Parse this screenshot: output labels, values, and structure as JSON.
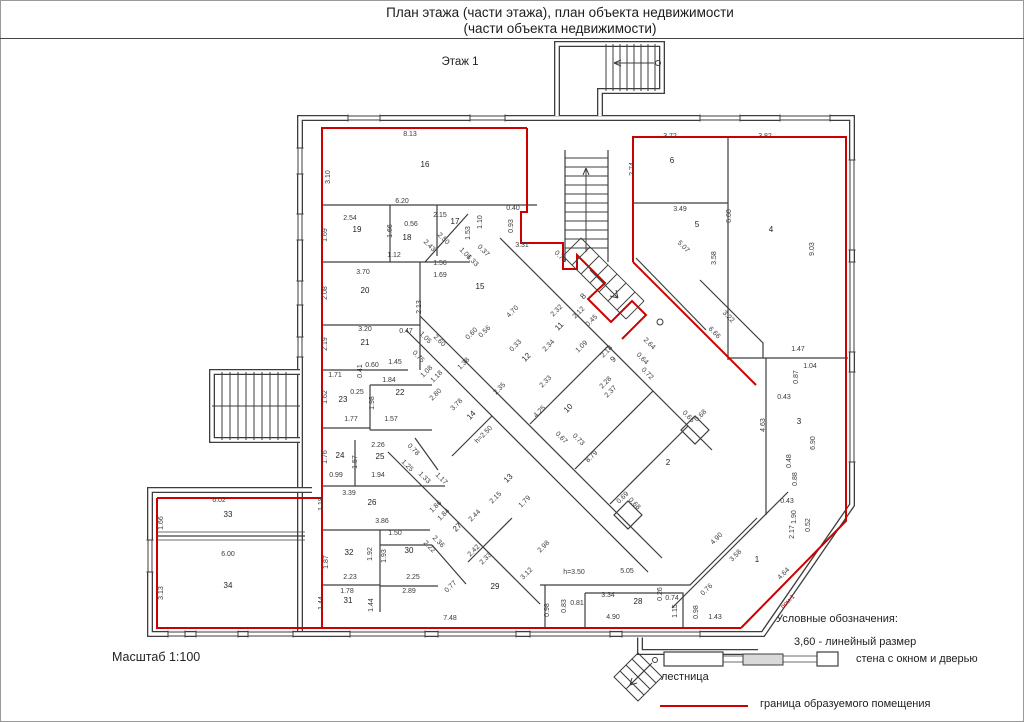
{
  "title": {
    "line1": "План этажа (части этажа), план объекта недвижимости",
    "line2": "(части объекта недвижимости)"
  },
  "floor_label": "Этаж 1",
  "scale_label": "Масштаб 1:100",
  "legend": {
    "heading": "Условные обозначения:",
    "linear_size": "3,60 - линейный размер",
    "wall_label": "стена с окном и дверью",
    "stairs_label": "лестница",
    "boundary_label": "граница образуемого помещения"
  },
  "colors": {
    "boundary": "#cc0000",
    "walls": "#3d3d3d",
    "text": "#3a3a3a",
    "legend_wall_fill": "#d9d9d9"
  },
  "plan": {
    "rooms": [
      [
        "1",
        757,
        562,
        0
      ],
      [
        "2",
        668,
        465,
        0
      ],
      [
        "3",
        799,
        424,
        0
      ],
      [
        "4",
        771,
        232,
        0
      ],
      [
        "5",
        697,
        227,
        0
      ],
      [
        "6",
        672,
        163,
        0
      ],
      [
        "8",
        585,
        298,
        -45
      ],
      [
        "9",
        615,
        361,
        -45
      ],
      [
        "10",
        570,
        410,
        -45
      ],
      [
        "11",
        561,
        328,
        -45
      ],
      [
        "12",
        528,
        359,
        -45
      ],
      [
        "13",
        510,
        480,
        -45
      ],
      [
        "14",
        473,
        417,
        -45
      ],
      [
        "15",
        480,
        289,
        0
      ],
      [
        "16",
        425,
        167,
        0
      ],
      [
        "17",
        455,
        224,
        0
      ],
      [
        "18",
        407,
        240,
        0
      ],
      [
        "19",
        357,
        232,
        0
      ],
      [
        "20",
        365,
        293,
        0
      ],
      [
        "21",
        365,
        345,
        0
      ],
      [
        "22",
        400,
        395,
        0
      ],
      [
        "23",
        343,
        402,
        0
      ],
      [
        "24",
        340,
        458,
        0
      ],
      [
        "25",
        380,
        459,
        0
      ],
      [
        "26",
        372,
        505,
        0
      ],
      [
        "27",
        459,
        529,
        -45
      ],
      [
        "28",
        638,
        604,
        0
      ],
      [
        "29",
        495,
        589,
        0
      ],
      [
        "30",
        409,
        553,
        0
      ],
      [
        "31",
        348,
        603,
        0
      ],
      [
        "32",
        349,
        555,
        0
      ],
      [
        "33",
        228,
        517,
        0
      ],
      [
        "34",
        228,
        588,
        0
      ]
    ],
    "dims": [
      [
        "8.13",
        410,
        136,
        0
      ],
      [
        "6.20",
        402,
        203,
        0
      ],
      [
        "2.54",
        350,
        220,
        0
      ],
      [
        "0.56",
        411,
        226,
        0
      ],
      [
        "2.15",
        440,
        217,
        0
      ],
      [
        "1.12",
        394,
        257,
        0
      ],
      [
        "0.40",
        513,
        210,
        0
      ],
      [
        "3.31",
        522,
        247,
        0
      ],
      [
        "1.56",
        440,
        265,
        0
      ],
      [
        "1.69",
        440,
        277,
        0
      ],
      [
        "3.70",
        363,
        274,
        0
      ],
      [
        "3.72",
        670,
        138,
        0
      ],
      [
        "3.82",
        765,
        138,
        0
      ],
      [
        "3.49",
        680,
        211,
        0
      ],
      [
        "3.20",
        365,
        331,
        0
      ],
      [
        "0.47",
        406,
        333,
        0
      ],
      [
        "1.45",
        395,
        364,
        0
      ],
      [
        "0.60",
        372,
        367,
        0
      ],
      [
        "1.71",
        335,
        377,
        0
      ],
      [
        "1.84",
        389,
        382,
        0
      ],
      [
        "0.25",
        357,
        394,
        0
      ],
      [
        "1.77",
        351,
        421,
        0
      ],
      [
        "1.57",
        391,
        421,
        0
      ],
      [
        "2.26",
        378,
        447,
        0
      ],
      [
        "0.99",
        336,
        477,
        0
      ],
      [
        "1.94",
        378,
        477,
        0
      ],
      [
        "3.39",
        349,
        495,
        0
      ],
      [
        "6.02",
        219,
        502,
        0
      ],
      [
        "6.00",
        228,
        556,
        0
      ],
      [
        "3.86",
        382,
        523,
        0
      ],
      [
        "1.50",
        395,
        535,
        0
      ],
      [
        "2.23",
        350,
        579,
        0
      ],
      [
        "1.78",
        347,
        593,
        0
      ],
      [
        "2.25",
        413,
        579,
        0
      ],
      [
        "2.89",
        409,
        593,
        0
      ],
      [
        "7.48",
        450,
        620,
        0
      ],
      [
        "h=3.50",
        574,
        574,
        0
      ],
      [
        "5.05",
        627,
        573,
        0
      ],
      [
        "3.34",
        608,
        597,
        0
      ],
      [
        "0.81",
        577,
        605,
        0
      ],
      [
        "0.74",
        672,
        600,
        0
      ],
      [
        "4.90",
        613,
        619,
        0
      ],
      [
        "1.43",
        715,
        619,
        0
      ],
      [
        "1.47",
        798,
        351,
        0
      ],
      [
        "1.04",
        810,
        368,
        0
      ],
      [
        "0.43",
        784,
        399,
        0
      ],
      [
        "0.43",
        787,
        503,
        0
      ],
      [
        "3.10",
        330,
        177,
        -90
      ],
      [
        "1.69",
        327,
        235,
        -90
      ],
      [
        "1.66",
        392,
        231,
        -90
      ],
      [
        "1.53",
        470,
        233,
        -90
      ],
      [
        "1.10",
        482,
        222,
        -90
      ],
      [
        "0.93",
        513,
        226,
        -90
      ],
      [
        "2.74",
        634,
        169,
        -90
      ],
      [
        "6.60",
        731,
        216,
        -90
      ],
      [
        "3.58",
        716,
        258,
        -90
      ],
      [
        "9.03",
        814,
        249,
        -90
      ],
      [
        "2.08",
        327,
        293,
        -90
      ],
      [
        "2.13",
        421,
        307,
        -90
      ],
      [
        "2.19",
        327,
        344,
        -90
      ],
      [
        "0.41",
        362,
        371,
        -90
      ],
      [
        "1.62",
        327,
        397,
        -90
      ],
      [
        "1.98",
        374,
        403,
        -90
      ],
      [
        "1.76",
        327,
        457,
        -90
      ],
      [
        "1.57",
        357,
        462,
        -90
      ],
      [
        "1.87",
        328,
        562,
        -90
      ],
      [
        "1.66",
        163,
        523,
        -90
      ],
      [
        "3.13",
        163,
        593,
        -90
      ],
      [
        "1.18",
        323,
        504,
        -90
      ],
      [
        "1.44",
        323,
        603,
        -90
      ],
      [
        "1.44",
        373,
        605,
        -90
      ],
      [
        "1.92",
        372,
        554,
        -90
      ],
      [
        "1.93",
        386,
        556,
        -90
      ],
      [
        "0.83",
        566,
        606,
        -90
      ],
      [
        "0.26",
        662,
        594,
        -90
      ],
      [
        "1.15",
        677,
        611,
        -90
      ],
      [
        "0.98",
        549,
        610,
        -90
      ],
      [
        "0.98",
        698,
        612,
        -90
      ],
      [
        "0.87",
        798,
        377,
        -90
      ],
      [
        "4.63",
        765,
        425,
        -90
      ],
      [
        "6.90",
        815,
        443,
        -90
      ],
      [
        "0.48",
        791,
        461,
        -90
      ],
      [
        "0.88",
        797,
        479,
        -90
      ],
      [
        "2.17",
        794,
        532,
        -90
      ],
      [
        "0.52",
        810,
        525,
        -90
      ],
      [
        "1.90",
        796,
        517,
        -90
      ],
      [
        "2.32",
        558,
        312,
        -45
      ],
      [
        "2.12",
        580,
        314,
        -45
      ],
      [
        "0.45",
        593,
        322,
        -45
      ],
      [
        "2.34",
        550,
        347,
        -45
      ],
      [
        "1.09",
        583,
        348,
        -45
      ],
      [
        "0.33",
        517,
        347,
        -45
      ],
      [
        "2.18",
        608,
        353,
        -45
      ],
      [
        "2.28",
        607,
        384,
        -45
      ],
      [
        "2.37",
        612,
        393,
        -45
      ],
      [
        "4.25",
        541,
        413,
        -45
      ],
      [
        "8.79",
        593,
        458,
        -45
      ],
      [
        "h=2.50",
        485,
        436,
        -45
      ],
      [
        "3.78",
        458,
        406,
        -45
      ],
      [
        "2.80",
        437,
        396,
        -45
      ],
      [
        "1.08",
        428,
        373,
        -45
      ],
      [
        "1.18",
        438,
        378,
        -45
      ],
      [
        "1.38",
        465,
        365,
        -45
      ],
      [
        "0.60",
        473,
        335,
        -45
      ],
      [
        "0.56",
        486,
        333,
        -45
      ],
      [
        "4.70",
        514,
        313,
        -45
      ],
      [
        "2.33",
        547,
        383,
        -45
      ],
      [
        "2.35",
        501,
        390,
        -45
      ],
      [
        "2.15",
        497,
        499,
        -45
      ],
      [
        "1.79",
        526,
        503,
        -45
      ],
      [
        "2.44",
        476,
        517,
        -45
      ],
      [
        "2.42",
        475,
        552,
        -45
      ],
      [
        "2.33",
        487,
        560,
        -45
      ],
      [
        "3.12",
        528,
        575,
        -45
      ],
      [
        "2.98",
        545,
        548,
        -45
      ],
      [
        "0.77",
        452,
        588,
        -45
      ],
      [
        "1.86",
        437,
        508,
        -45
      ],
      [
        "1.84",
        445,
        516,
        -45
      ],
      [
        "4.90",
        718,
        540,
        -45
      ],
      [
        "3.58",
        737,
        557,
        -45
      ],
      [
        "4.64",
        785,
        575,
        -45
      ],
      [
        "0.76",
        708,
        591,
        -45
      ],
      [
        "0.68",
        702,
        417,
        -45
      ],
      [
        "0.69",
        624,
        499,
        -45
      ],
      [
        "2.50",
        442,
        240,
        45
      ],
      [
        "2.43",
        428,
        247,
        45
      ],
      [
        "1.06",
        464,
        255,
        45
      ],
      [
        "1.33",
        471,
        262,
        45
      ],
      [
        "0.37",
        482,
        252,
        45
      ],
      [
        "5.07",
        682,
        248,
        45
      ],
      [
        "3.22",
        727,
        318,
        45
      ],
      [
        "6.66",
        713,
        334,
        45
      ],
      [
        "2.60",
        438,
        342,
        45
      ],
      [
        "0.75",
        417,
        358,
        45
      ],
      [
        "1.05",
        424,
        339,
        45
      ],
      [
        "1.25",
        406,
        467,
        45
      ],
      [
        "0.78",
        412,
        451,
        45
      ],
      [
        "1.33",
        423,
        479,
        45
      ],
      [
        "1.17",
        440,
        480,
        45
      ],
      [
        "2.22",
        428,
        548,
        45
      ],
      [
        "2.36",
        437,
        543,
        45
      ],
      [
        "2.64",
        648,
        345,
        45
      ],
      [
        "0.64",
        641,
        360,
        45
      ],
      [
        "0.72",
        646,
        375,
        45
      ],
      [
        "0.67",
        560,
        439,
        45
      ],
      [
        "0.73",
        577,
        441,
        45
      ],
      [
        "0.65",
        687,
        418,
        45
      ],
      [
        "0.68",
        633,
        505,
        45
      ],
      [
        "0.73",
        559,
        258,
        45
      ]
    ],
    "special_labels": [
      [
        "пом.1",
        789,
        603,
        -45,
        "red"
      ]
    ]
  }
}
